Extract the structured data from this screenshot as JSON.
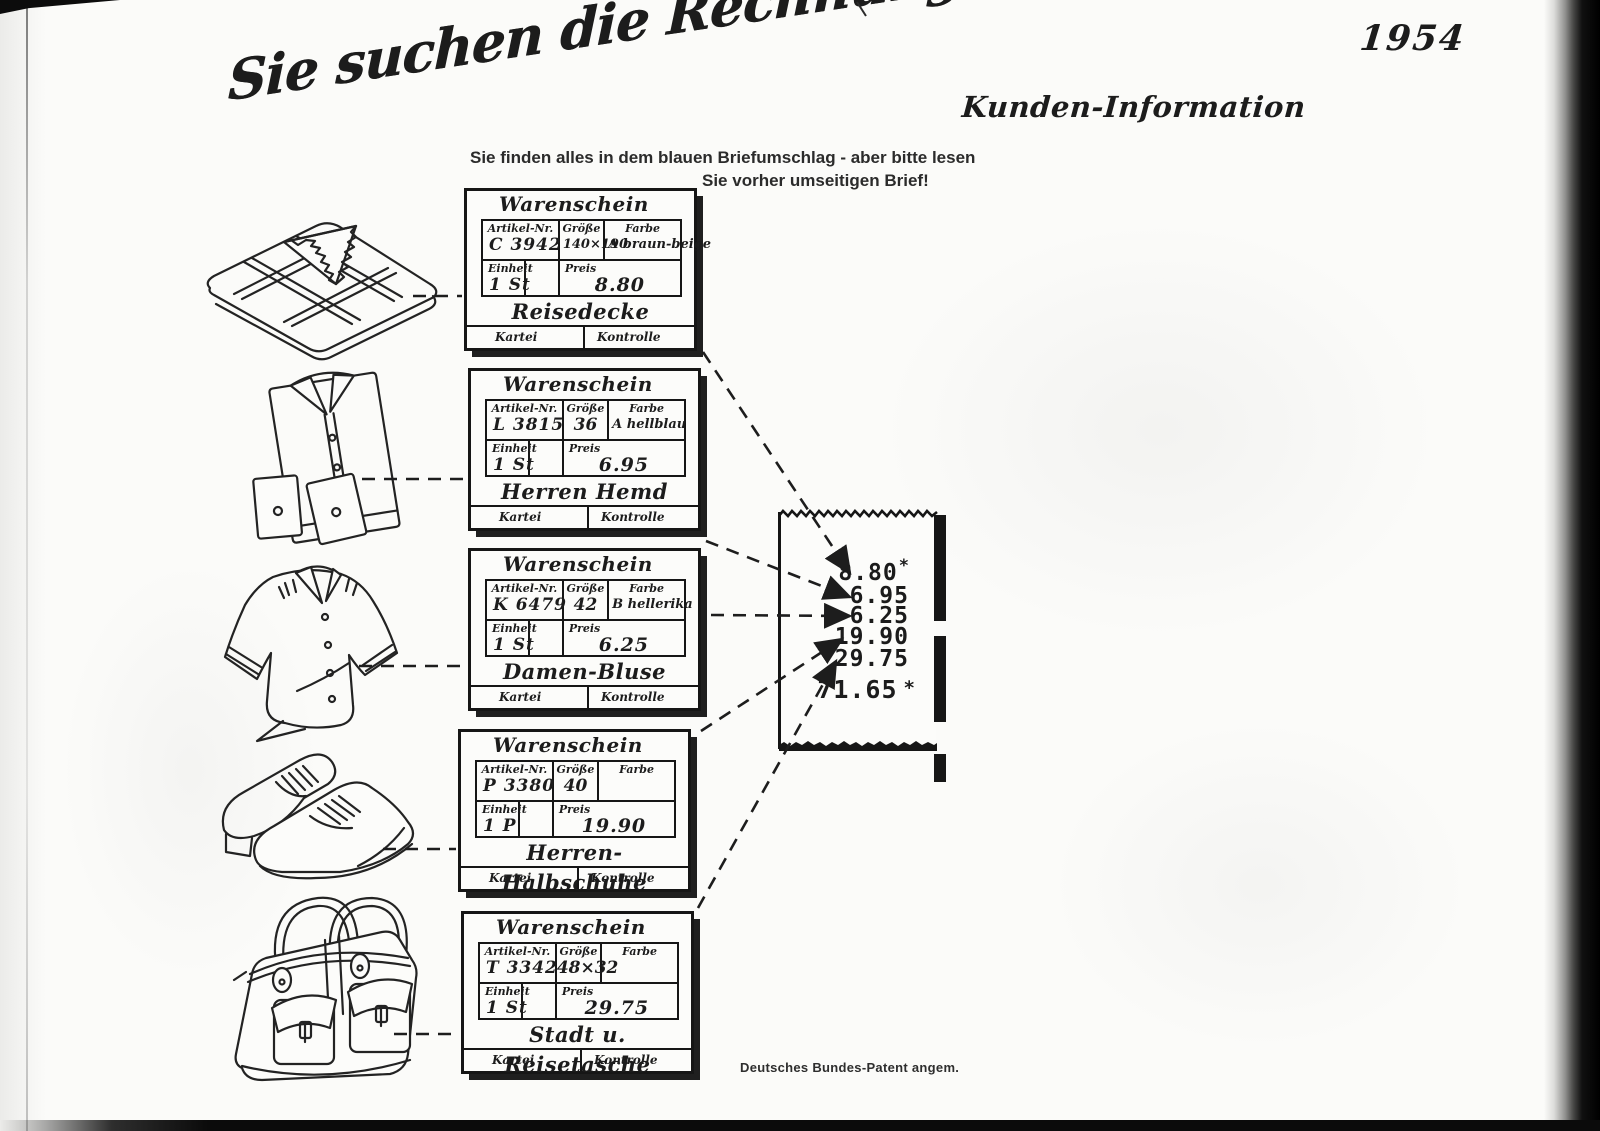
{
  "page": {
    "year": "1954",
    "corner_label": "Kunden-Information",
    "headline": "Sie suchen die Rechnung ?",
    "subline1": "Sie finden alles in dem blauen Briefumschlag - aber bitte lesen",
    "subline2": "Sie vorher umseitigen Brief!",
    "patent_note": "Deutsches Bundes-Patent angem."
  },
  "card_labels": {
    "title": "Warenschein",
    "artikel": "Artikel-Nr.",
    "groesse": "Größe",
    "farbe": "Farbe",
    "einheit": "Einheit",
    "preis": "Preis",
    "kartei": "Kartei",
    "kontrolle": "Kontrolle"
  },
  "cards": [
    {
      "artikel_nr": "C 3942",
      "groesse": "140×190",
      "farbe": "A braun-beige",
      "einheit": "1 St",
      "preis": "8.80",
      "product": "Reisedecke"
    },
    {
      "artikel_nr": "L 3815",
      "groesse": "36",
      "farbe": "A hellblau",
      "einheit": "1 St",
      "preis": "6.95",
      "product": "Herren Hemd"
    },
    {
      "artikel_nr": "K 6479",
      "groesse": "42",
      "farbe": "B hellerika",
      "einheit": "1 St",
      "preis": "6.25",
      "product": "Damen-Bluse"
    },
    {
      "artikel_nr": "P 3380",
      "groesse": "40",
      "farbe": "",
      "einheit": "1 P",
      "preis": "19.90",
      "product": "Herren-Halbschuhe"
    },
    {
      "artikel_nr": "T 3342",
      "groesse": "48×32",
      "farbe": "",
      "einheit": "1 St",
      "preis": "29.75",
      "product": "Stadt u. Reisetasche"
    }
  ],
  "receipt": {
    "items": [
      "8.80",
      "6.95",
      "6.25",
      "19.90",
      "29.75"
    ],
    "item_marks": [
      "*",
      "",
      "",
      "",
      ""
    ],
    "total": "71.65",
    "total_mark": "*",
    "ink_color": "#1b1b1b"
  }
}
